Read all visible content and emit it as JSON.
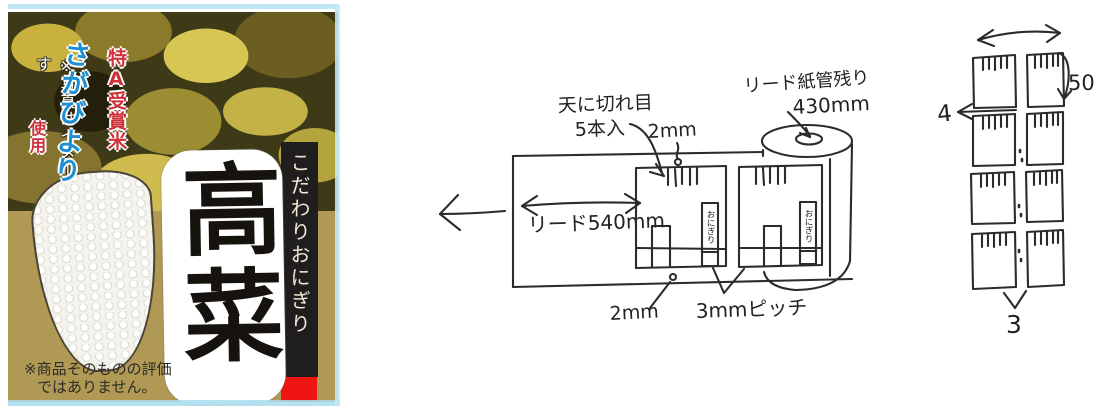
{
  "product_label": {
    "photo_note": "※写真はイメージです",
    "ribbon_text": "こだわりおにぎり",
    "product_name": "高菜",
    "rice_badge": {
      "award": "特A受賞米",
      "variety": "さがびより",
      "usage": "使用"
    },
    "disclaimer_line1": "※商品そのものの評価",
    "disclaimer_line2": "ではありません。",
    "colors": {
      "gold_background": "#b09955",
      "ribbon_black": "#201d1f",
      "accent_red": "#ee1512",
      "award_red": "#d0303a",
      "variety_blue": "#1e8fd0"
    }
  },
  "roll_sketch": {
    "cut_note_line1": "天に切れ目",
    "cut_note_line2": "5本入",
    "dim_top": "2mm",
    "lead_dim": "リード540mm",
    "core_note_line1": "リード紙管残り",
    "core_note_line2": "430mm",
    "dim_bottom": "2mm",
    "pitch_dim": "3mmピッチ",
    "package_text": "おにぎり"
  },
  "sheet_sketch": {
    "dim_height": "50",
    "dim_gap": "4",
    "dim_pitch": "3"
  }
}
